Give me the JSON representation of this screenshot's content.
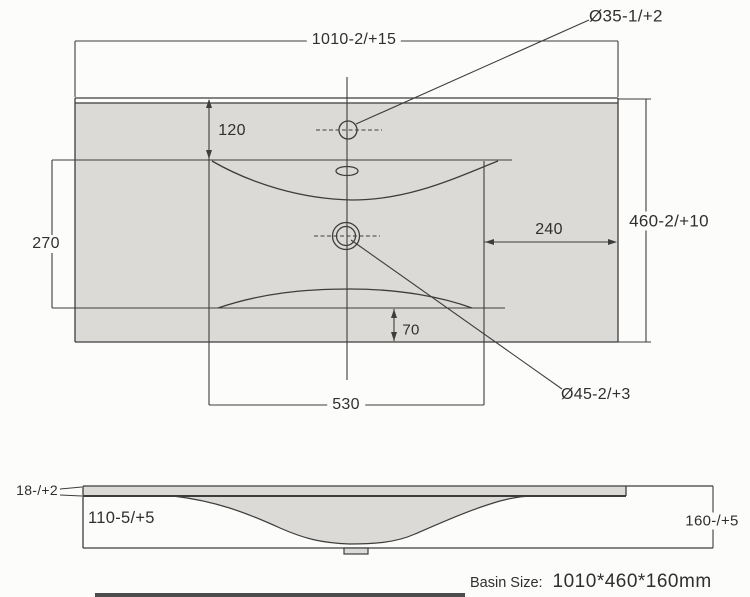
{
  "drawing": {
    "top_view": {
      "overall_width": "1010-2/+15",
      "overall_depth": "460-2/+10",
      "faucet_hole": "Ø35-1/+2",
      "drain_hole": "Ø45-2/+3",
      "faucet_from_back": "120",
      "bowl_depth": "270",
      "drain_from_right": "240",
      "bowl_width": "530",
      "bowl_from_front": "70"
    },
    "side_view": {
      "rim_thickness": "18-/+2",
      "bowl_inner_depth": "110-5/+5",
      "overall_height": "160-/+5"
    },
    "caption": {
      "label": "Basin Size:",
      "value": "1010*460*160mm"
    }
  },
  "colors": {
    "background": "#fcfcfa",
    "surface_fill": "#dbdad7",
    "line": "#3d3d3d",
    "text": "#2f2f2f"
  }
}
